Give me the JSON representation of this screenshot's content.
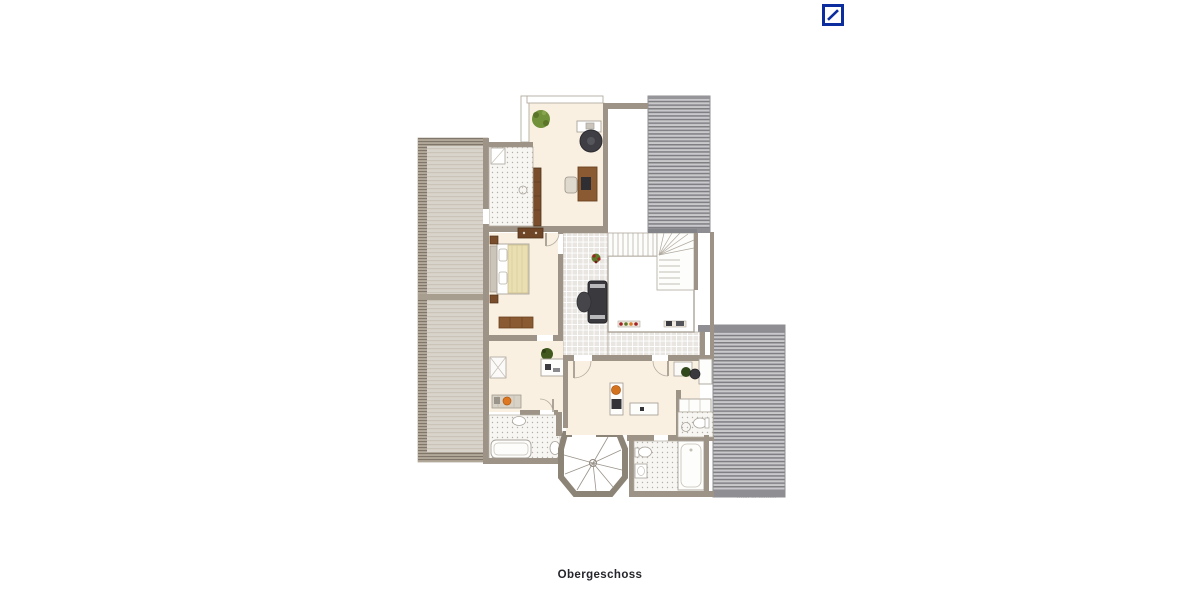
{
  "brand": {
    "logo_icon": "deutsche-bank-slash-logo",
    "logo_color": "#0B2D9E"
  },
  "plan": {
    "caption": "Obergeschoss",
    "watermark": "······· ··· ··········"
  },
  "colors": {
    "background": "#ffffff",
    "floor_cream": "#faf0e2",
    "wall": "#9d9386",
    "roof_left_light": "#d9d4cb",
    "roof_gray": "#c9c9cc",
    "roof_stripe_dark": "#7e7e83",
    "tile_gray": "#e9e6e1",
    "wood_brown": "#8a5a33",
    "dark_furniture": "#3a3a3e",
    "plant_green": "#71913a",
    "accent_orange": "#d4731f",
    "duvet_yellow": "#e9dfb2"
  }
}
